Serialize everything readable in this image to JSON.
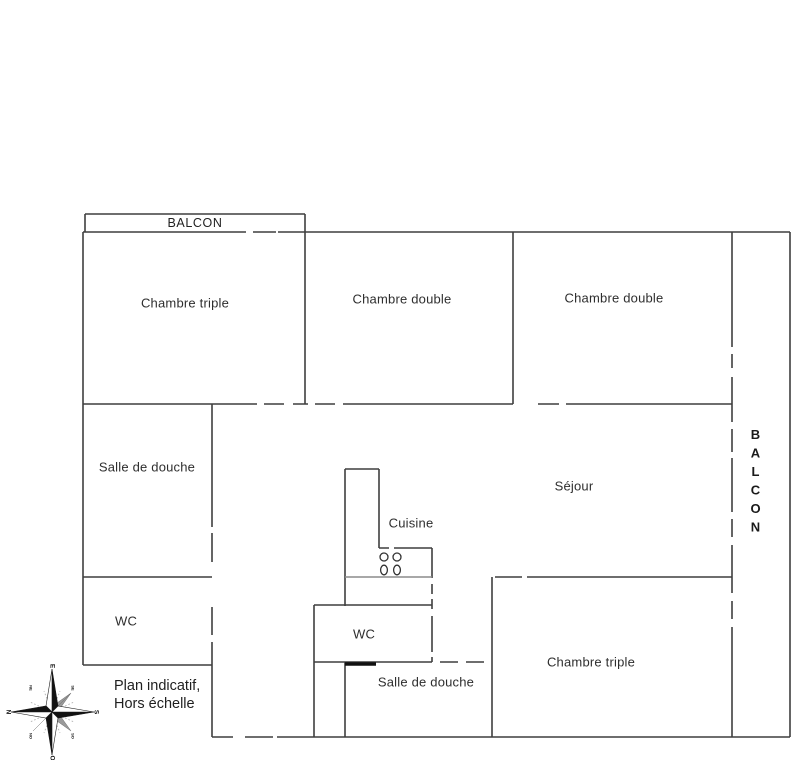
{
  "plan": {
    "balcony_top_label": "BALCON",
    "balcony_right_label": "BALCON",
    "note_line1": "Plan indicatif,",
    "note_line2": "Hors échelle",
    "rooms": [
      {
        "id": "chambre-triple-top",
        "label": "Chambre triple"
      },
      {
        "id": "chambre-double-middle",
        "label": "Chambre double"
      },
      {
        "id": "chambre-double-right",
        "label": "Chambre double"
      },
      {
        "id": "salle-de-douche-left",
        "label": "Salle de douche"
      },
      {
        "id": "wc-left",
        "label": "WC"
      },
      {
        "id": "sejour",
        "label": "Séjour"
      },
      {
        "id": "cuisine",
        "label": "Cuisine"
      },
      {
        "id": "wc-middle",
        "label": "WC"
      },
      {
        "id": "salle-de-douche-bottom",
        "label": "Salle de douche"
      },
      {
        "id": "chambre-triple-bottom",
        "label": "Chambre triple"
      }
    ],
    "compass": {
      "north": "N",
      "east": "E",
      "south": "S",
      "west": "O",
      "north_east": "NE",
      "south_east": "SE",
      "south_west": "SO",
      "north_west": "NO"
    }
  },
  "colors": {
    "wall": "#3f3f3f",
    "wall_light": "#8c8c8c",
    "threshold": "#111111",
    "text": "#2e2e2e",
    "background": "#ffffff"
  }
}
